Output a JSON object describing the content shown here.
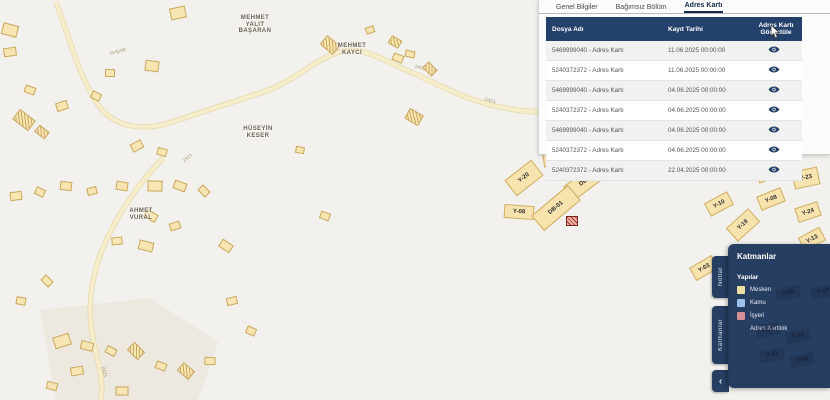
{
  "colors": {
    "map_bg": "#f3f1ed",
    "building_fill": "#f7e5b2",
    "building_border": "#c9a85f",
    "road_fill": "#f6eecb",
    "road_casing": "#e4d9ad",
    "navy": "#24416b",
    "legend_mesken": "#efdfa0",
    "legend_kamu": "#9fc0e8",
    "legend_isyeri": "#d78f97"
  },
  "detail_panel": {
    "tabs": [
      {
        "label": "Genel Bilgiler",
        "active": false
      },
      {
        "label": "Bağımsız Bölüm",
        "active": false
      },
      {
        "label": "Adres Kartı",
        "active": true
      }
    ],
    "table": {
      "columns": [
        "Dosya Adı",
        "Kayıt Tarihi",
        "Adres Kartı Görüntüle"
      ],
      "rows": [
        {
          "file": "5469999040 - Adres Kartı",
          "date": "11.06.2025 00:00:00"
        },
        {
          "file": "5240372372 - Adres Kartı",
          "date": "11.06.2025 00:00:00"
        },
        {
          "file": "5469999040 - Adres Kartı",
          "date": "04.06.2025 00:00:00"
        },
        {
          "file": "5240372372 - Adres Kartı",
          "date": "04.06.2025 00:00:00"
        },
        {
          "file": "5469999040 - Adres Kartı",
          "date": "04.06.2025 00:00:00"
        },
        {
          "file": "5240372372 - Adres Kartı",
          "date": "04.06.2025 00:00:00"
        },
        {
          "file": "5240372372 - Adres Kartı",
          "date": "22.04.2025 00:00:00"
        }
      ]
    }
  },
  "layers_panel": {
    "title": "Katmanlar",
    "section": "Yapılar",
    "items": [
      {
        "label": "Mesken",
        "color": "#efdfa0"
      },
      {
        "label": "Kamu",
        "color": "#9fc0e8"
      },
      {
        "label": "İşyeri",
        "color": "#d78f97"
      }
    ],
    "extra_item": "Adres Kartlılık",
    "side_tabs": [
      "Notlar",
      "Katmanlar"
    ],
    "collapse_icon": "‹"
  },
  "map": {
    "name_labels": [
      {
        "text": "MEHMET\nYALIT\nBAŞARAN",
        "x": 255,
        "y": 15
      },
      {
        "text": "MEHMET\nKAYCI",
        "x": 352,
        "y": 43
      },
      {
        "text": "HÜSEYİN\nKESER",
        "x": 258,
        "y": 126
      },
      {
        "text": "AHMET\nVURAL",
        "x": 141,
        "y": 208
      }
    ],
    "road_labels": [
      {
        "text": "AVŞAR",
        "x": 118,
        "y": 52,
        "rot": -14
      },
      {
        "text": "2421",
        "x": 330,
        "y": 47,
        "rot": -14
      },
      {
        "text": "2421",
        "x": 420,
        "y": 68,
        "rot": 12
      },
      {
        "text": "2421",
        "x": 188,
        "y": 158,
        "rot": -38
      },
      {
        "text": "2421",
        "x": 490,
        "y": 101,
        "rot": 14
      },
      {
        "text": "2421",
        "x": 104,
        "y": 372,
        "rot": 78
      }
    ],
    "roads": [
      "M56,2 C70,40 80,78 97,103 C112,127 142,132 172,122 C212,109 242,99 266,91 C292,82 312,62 336,53 C362,44 382,60 406,70 C428,79 450,92 474,100 C498,108 520,111 538,112",
      "M163,158 C138,184 117,214 102,250 C90,281 86,316 96,352 C101,374 103,386 101,400"
    ],
    "parcels": [
      {
        "label": "Y-21",
        "x": 558,
        "y": 158,
        "w": 30,
        "h": 15,
        "rot": -8
      },
      {
        "label": "Y-20",
        "x": 524,
        "y": 178,
        "w": 34,
        "h": 20,
        "rot": -38
      },
      {
        "label": "DB-02",
        "x": 587,
        "y": 180,
        "w": 46,
        "h": 18,
        "rot": -37
      },
      {
        "label": "Y-08",
        "x": 519,
        "y": 212,
        "w": 30,
        "h": 14,
        "rot": 4
      },
      {
        "label": "DB-01",
        "x": 556,
        "y": 208,
        "w": 48,
        "h": 20,
        "rot": -40
      },
      {
        "label": "Y-22",
        "x": 768,
        "y": 172,
        "w": 24,
        "h": 16,
        "rot": -20
      },
      {
        "label": "Y-23",
        "x": 806,
        "y": 178,
        "w": 26,
        "h": 18,
        "rot": -12
      },
      {
        "label": "Y-10",
        "x": 719,
        "y": 204,
        "w": 26,
        "h": 15,
        "rot": -28
      },
      {
        "label": "Y-08",
        "x": 771,
        "y": 199,
        "w": 26,
        "h": 15,
        "rot": -22
      },
      {
        "label": "Y-24",
        "x": 808,
        "y": 212,
        "w": 24,
        "h": 15,
        "rot": -18
      },
      {
        "label": "Y-19",
        "x": 743,
        "y": 225,
        "w": 30,
        "h": 18,
        "rot": -42
      },
      {
        "label": "Y-13",
        "x": 812,
        "y": 239,
        "w": 24,
        "h": 15,
        "rot": -28
      },
      {
        "label": "Y-03",
        "x": 704,
        "y": 268,
        "w": 26,
        "h": 15,
        "rot": -30
      }
    ],
    "ghost_parcels": [
      {
        "label": "Y-16",
        "x": 788,
        "y": 293
      },
      {
        "label": "Y-17",
        "x": 823,
        "y": 292
      },
      {
        "label": "Y-12",
        "x": 768,
        "y": 330
      },
      {
        "label": "Y-11",
        "x": 798,
        "y": 336
      },
      {
        "label": "Y-01",
        "x": 772,
        "y": 355
      },
      {
        "label": "Y-02",
        "x": 802,
        "y": 360
      }
    ],
    "buildings": [
      [
        10,
        30,
        16,
        12,
        15,
        "p"
      ],
      [
        10,
        52,
        13,
        9,
        -8,
        "p"
      ],
      [
        30,
        90,
        11,
        8,
        20,
        "p"
      ],
      [
        24,
        120,
        20,
        13,
        38,
        "h"
      ],
      [
        42,
        132,
        13,
        9,
        38,
        "h"
      ],
      [
        62,
        106,
        12,
        9,
        -18,
        "p"
      ],
      [
        96,
        96,
        10,
        8,
        28,
        "p"
      ],
      [
        178,
        13,
        16,
        12,
        -12,
        "p"
      ],
      [
        152,
        66,
        14,
        11,
        8,
        "p"
      ],
      [
        110,
        73,
        10,
        8,
        0,
        "p"
      ],
      [
        330,
        45,
        17,
        12,
        40,
        "h"
      ],
      [
        370,
        30,
        9,
        7,
        -20,
        "p"
      ],
      [
        395,
        42,
        12,
        9,
        30,
        "h"
      ],
      [
        410,
        54,
        10,
        7,
        12,
        "p"
      ],
      [
        398,
        58,
        11,
        8,
        22,
        "p"
      ],
      [
        430,
        69,
        13,
        9,
        45,
        "h"
      ],
      [
        414,
        117,
        16,
        12,
        30,
        "h"
      ],
      [
        300,
        150,
        9,
        7,
        10,
        "p"
      ],
      [
        137,
        146,
        12,
        9,
        -28,
        "p"
      ],
      [
        162,
        152,
        10,
        8,
        14,
        "p"
      ],
      [
        180,
        186,
        13,
        9,
        20,
        "p"
      ],
      [
        204,
        191,
        11,
        8,
        45,
        "p"
      ],
      [
        155,
        186,
        15,
        11,
        2,
        "p"
      ],
      [
        122,
        186,
        12,
        9,
        10,
        "p"
      ],
      [
        92,
        191,
        10,
        8,
        -14,
        "p"
      ],
      [
        66,
        186,
        12,
        9,
        6,
        "p"
      ],
      [
        40,
        192,
        10,
        8,
        24,
        "p"
      ],
      [
        16,
        196,
        12,
        9,
        -8,
        "p"
      ],
      [
        151,
        216,
        13,
        9,
        30,
        "p"
      ],
      [
        175,
        226,
        11,
        8,
        -18,
        "p"
      ],
      [
        146,
        246,
        15,
        10,
        14,
        "p"
      ],
      [
        117,
        241,
        11,
        8,
        -6,
        "p"
      ],
      [
        226,
        246,
        13,
        9,
        34,
        "p"
      ],
      [
        325,
        216,
        10,
        8,
        20,
        "p"
      ],
      [
        47,
        281,
        11,
        8,
        44,
        "p"
      ],
      [
        21,
        301,
        10,
        8,
        10,
        "p"
      ],
      [
        232,
        301,
        11,
        8,
        -14,
        "p"
      ],
      [
        251,
        331,
        10,
        8,
        24,
        "p"
      ],
      [
        62,
        341,
        17,
        12,
        -18,
        "p"
      ],
      [
        87,
        346,
        13,
        9,
        14,
        "p"
      ],
      [
        111,
        351,
        11,
        8,
        28,
        "p"
      ],
      [
        136,
        351,
        15,
        11,
        45,
        "h"
      ],
      [
        161,
        366,
        11,
        8,
        20,
        "p"
      ],
      [
        186,
        371,
        15,
        11,
        40,
        "h"
      ],
      [
        210,
        361,
        11,
        8,
        2,
        "p"
      ],
      [
        77,
        371,
        13,
        9,
        -10,
        "p"
      ],
      [
        52,
        386,
        11,
        8,
        14,
        "p"
      ],
      [
        122,
        391,
        13,
        9,
        0,
        "p"
      ],
      [
        572,
        221,
        12,
        10,
        0,
        "r"
      ]
    ]
  }
}
